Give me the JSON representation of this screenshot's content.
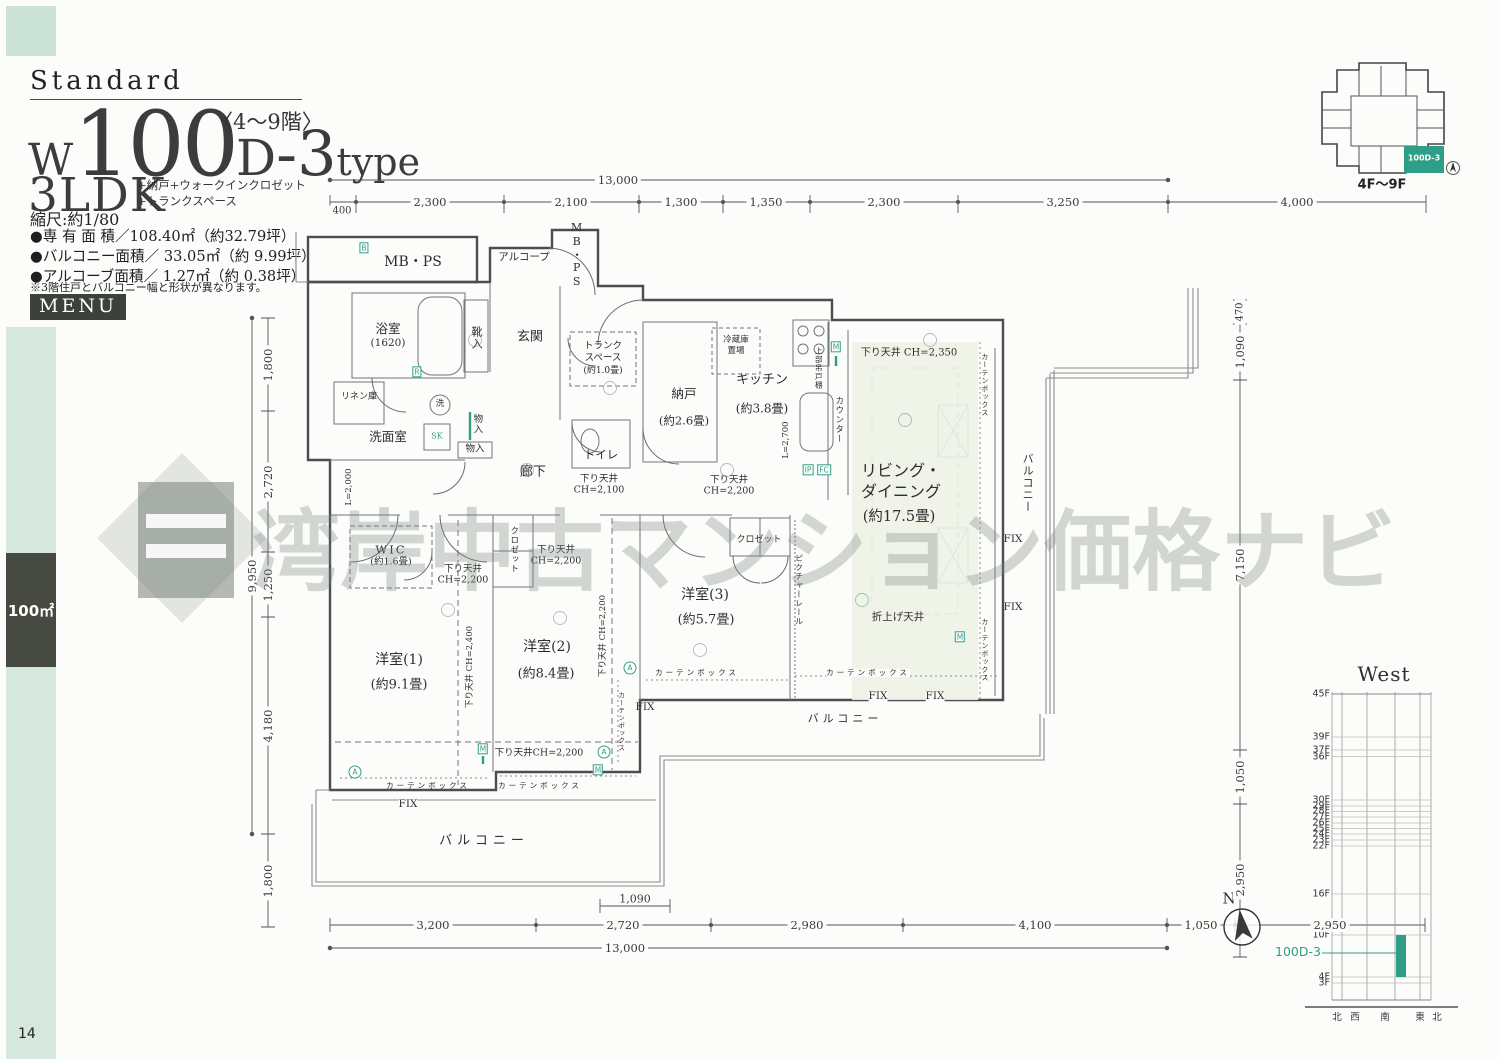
{
  "header": {
    "standard": "Standard",
    "floors_range": "〈4〜9階〉",
    "type_w": "W",
    "type_num": "100",
    "type_d": "D",
    "type_dash3": "-3",
    "type_word": "type",
    "ldk": "3LDK",
    "ldk_sub1": "+納戸+ウォークインクロゼット",
    "ldk_sub2": "+トランクスペース",
    "scale_note": "縮尺:約1/80",
    "area1": "●専 有 面 積／108.40㎡（約32.79坪）",
    "area2": "●バルコニー面積／ 33.05㎡（約 9.99坪）",
    "area3": "●アルコーブ面積／ 1.27㎡（約 0.38坪）",
    "note": "※3階住戸とバルコニー幅と形状が異なります。",
    "menu": "MENU"
  },
  "sidebar": {
    "size_label": "100㎡",
    "page_number": "14"
  },
  "locator": {
    "unit": "100D-3",
    "floors": "4F〜9F"
  },
  "compass": {
    "n": "N"
  },
  "watermark": {
    "text": "湾岸中古マンション価格ナビ"
  },
  "plan": {
    "mbps": "MB・PS",
    "alcove": "アルコープ",
    "bath": "浴室",
    "bath_size": "(1620)",
    "shoes": "靴入",
    "entrance": "玄関",
    "trunk1": "トランク",
    "trunk2": "スペース",
    "trunk3": "(約1.0畳)",
    "linen": "リネン庫",
    "wash": "洗",
    "sk": "SK",
    "powder": "洗面室",
    "monoire": "物入",
    "toilet": "トイレ",
    "hall": "廊下",
    "nando": "納戸",
    "nando_size": "(約2.6畳)",
    "fridge1": "冷蔵庫",
    "fridge2": "置場",
    "kitchen": "キッチン",
    "kitchen_size": "(約3.8畳)",
    "counter": "カウンター",
    "cabinet": "上部吊戸棚",
    "l2700": "L=2,700",
    "l2000": "L=2,000",
    "living1": "リビング・",
    "living2": "ダイニング",
    "living_size": "(約17.5畳)",
    "ch2350": "下り天井 CH=2,350",
    "ch2100_1": "下り天井",
    "ch2100_2": "CH=2,100",
    "ch2200_1": "下り天井",
    "ch2200_2": "CH=2,200",
    "ch2200_line": "下り天井CH=2,200",
    "ch2200_v": "下り天井 CH=2,200",
    "ch2400_v": "下り天井 CH=2,400",
    "oriage": "折上げ天井",
    "wic": "WIC",
    "wic_size": "(約1.6畳)",
    "closet": "クロゼット",
    "picrail": "ピクチャーレール",
    "y1": "洋室(1)",
    "y1_size": "(約9.1畳)",
    "y2": "洋室(2)",
    "y2_size": "(約8.4畳)",
    "y3": "洋室(3)",
    "y3_size": "(約5.7畳)",
    "balcony": "バルコニー",
    "curtain": "カーテンボックス",
    "fix": "FIX",
    "mk_b": "B",
    "mk_m": "M",
    "mk_a": "A",
    "mk_r": "R",
    "mk_ip": "IP",
    "mk_fc": "FC"
  },
  "dims": {
    "top_total": "13,000",
    "t400": "400",
    "t2300a": "2,300",
    "t2100": "2,100",
    "t1300": "1,300",
    "t1350": "1,350",
    "t2300b": "2,300",
    "t3250": "3,250",
    "t4000": "4,000",
    "b3200": "3,200",
    "b2720": "2,720",
    "b2980": "2,980",
    "b4100": "4,100",
    "b1050": "1,050",
    "b2950": "2,950",
    "b1090": "1,090",
    "bottom_total": "13,000",
    "l1800a": "1,800",
    "l2720": "2,720",
    "l1250": "1,250",
    "l4180": "4,180",
    "l1800b": "1,800",
    "l9950": "9,950",
    "r470": "470",
    "r1090": "1,090",
    "r7150": "7,150",
    "r1050": "1,050",
    "r2950": "2,950"
  },
  "elevation": {
    "title": "West",
    "unit": "100D-3",
    "floors": [
      "45F",
      "39F",
      "37F",
      "36F",
      "30F",
      "29F",
      "28F",
      "27F",
      "26F",
      "25F",
      "24F",
      "23F",
      "22F",
      "16F",
      "10F",
      "4F",
      "3F"
    ],
    "directions": [
      "北",
      "西",
      "南",
      "東",
      "北"
    ]
  }
}
